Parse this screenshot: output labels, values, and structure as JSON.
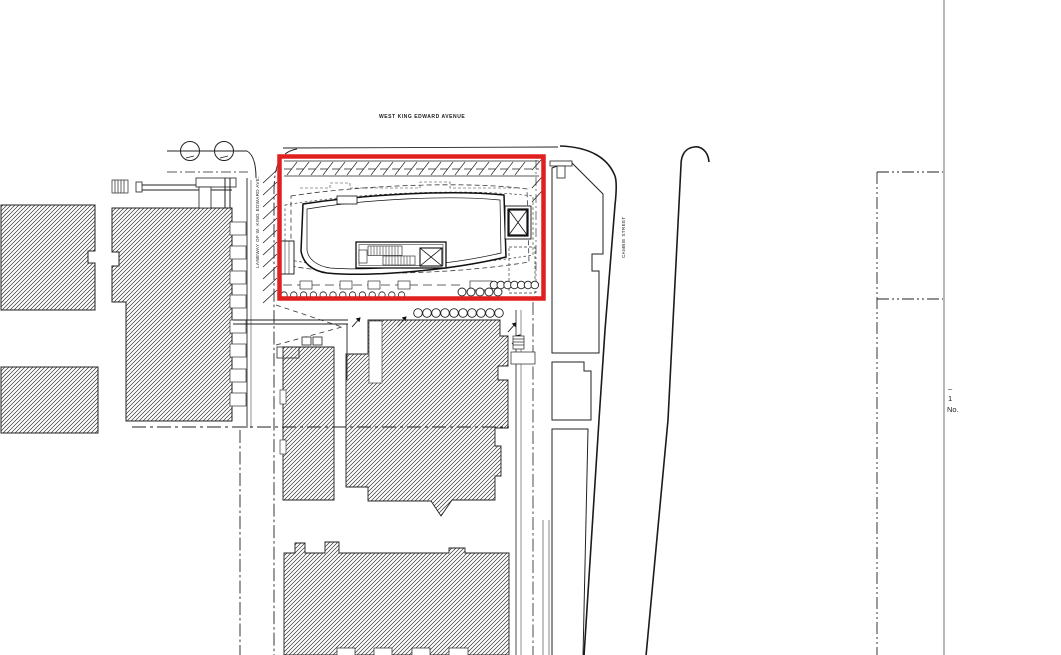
{
  "drawing": {
    "street_top_label": "WEST KING EDWARD AVENUE",
    "laneway_label": "LANEWAY OF W. KING EDWARD AVE.",
    "street_right_label": "CAMBIE STREET",
    "revision_strip": {
      "dash": "–",
      "number": "1",
      "no_label": "No."
    },
    "colors": {
      "site_outline_red": "#e01f1f",
      "ink": "#1b1b1b",
      "sheet_edge_gray": "#b1b1b1"
    }
  }
}
